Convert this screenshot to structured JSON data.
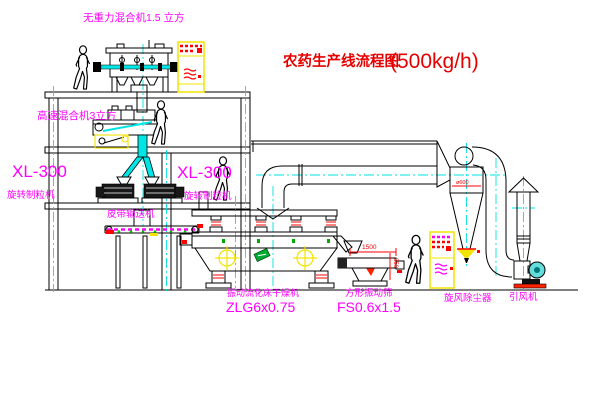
{
  "title": {
    "name_zh": "农药生产线流程图",
    "capacity": "(500kg/h)"
  },
  "equipment_labels": {
    "gravity_free_mixer": "无重力混合机1.5 立方",
    "high_speed_mixer": "高速混合机3立方",
    "left_granulator_model": "XL-300",
    "left_granulator_name": "旋转制粒机",
    "center_granulator_model": "XL-300",
    "center_granulator_name": "旋转制粒机",
    "belt_conveyor": "皮带输送机",
    "fluid_bed_dryer_name": "振动流化床干燥机",
    "fluid_bed_dryer_model": "ZLG6x0.75",
    "vibrating_screen_name": "方形振动筛",
    "vibrating_screen_model": "FS0.6x1.5",
    "cyclone_dust_collector": "旋风除尘器",
    "induced_draft_fan": "引风机"
  },
  "dimensions": {
    "screen_length": "1500",
    "screen_side_height": "350",
    "cyclone_diameter": "ø600"
  },
  "colors": {
    "label": "#ff00ff",
    "title": "#e60000",
    "outline": "#000000",
    "centerline": "#00e0e0",
    "cabinet": "#f2e400"
  }
}
